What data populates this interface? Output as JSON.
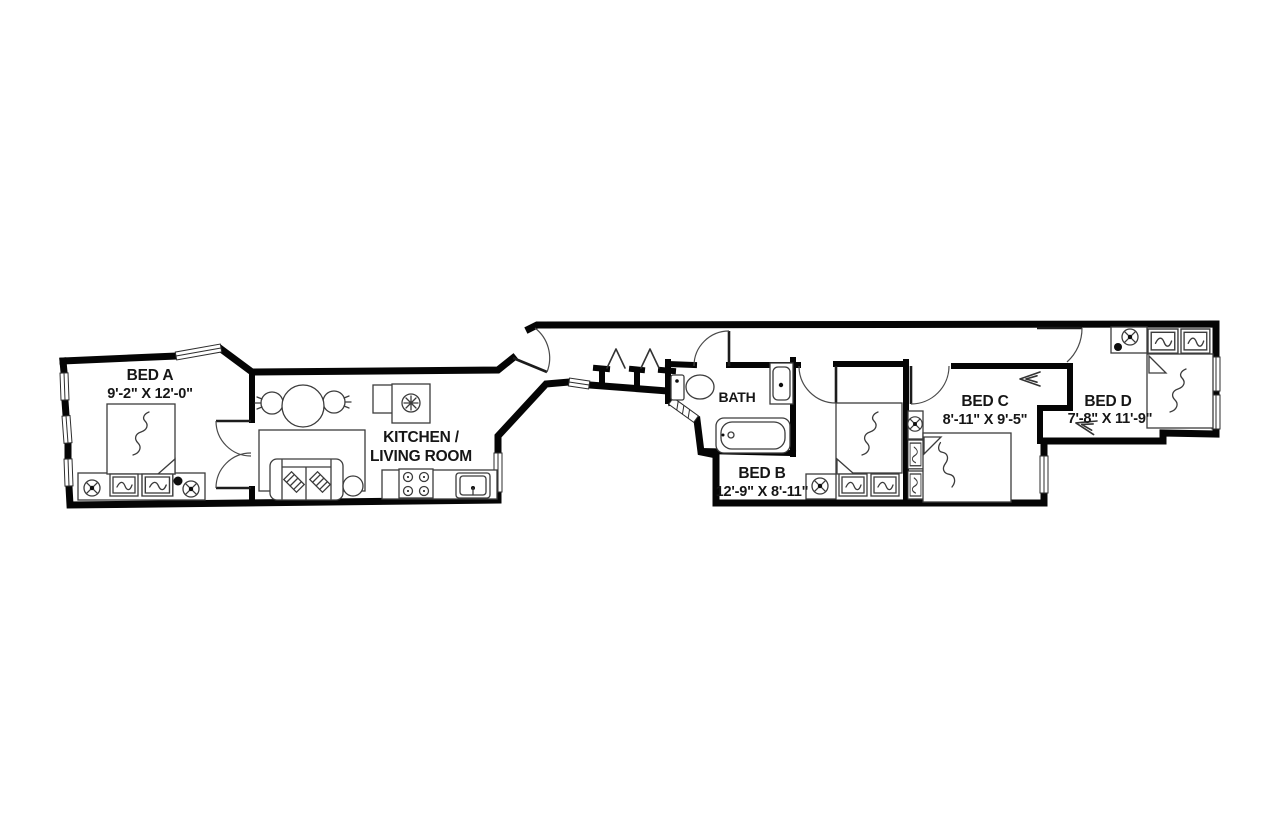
{
  "colors": {
    "background": "#ffffff",
    "wall": "#050505",
    "furniture_line": "#3c3c3c",
    "label_text": "#161616"
  },
  "floorplan": {
    "rooms": [
      {
        "id": "bed_a",
        "label": "BED A",
        "dims": "9'-2\" X 12'-0\""
      },
      {
        "id": "kitchen_living",
        "label_line1": "KITCHEN /",
        "label_line2": "LIVING ROOM"
      },
      {
        "id": "bath",
        "label": "BATH"
      },
      {
        "id": "bed_b",
        "label": "BED B",
        "dims": "12'-9\" X 8'-11\""
      },
      {
        "id": "bed_c",
        "label": "BED C",
        "dims": "8'-11\" X 9'-5\""
      },
      {
        "id": "bed_d",
        "label": "BED D",
        "dims": "7'-8\" X 11'-9\""
      }
    ],
    "fixtures": [
      {
        "icon": "ceiling-light-icon",
        "shape": "circle-with-cross"
      },
      {
        "icon": "detector-dot-icon",
        "shape": "filled-dot"
      },
      {
        "icon": "bifold-door-icon",
        "shape": "zigzag"
      }
    ]
  }
}
